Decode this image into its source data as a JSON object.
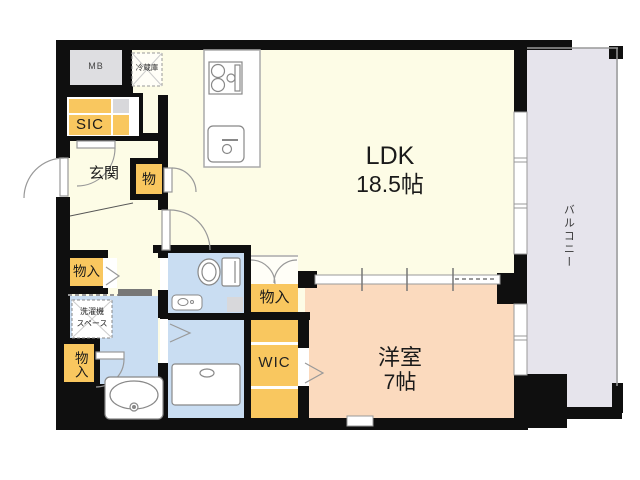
{
  "rooms": {
    "ldk": {
      "name": "LDK",
      "size": "18.5帖"
    },
    "western": {
      "name": "洋室",
      "size": "7帖"
    },
    "balcony": "バルコニー",
    "entrance": "玄関",
    "sic": "SIC",
    "wic": "WIC",
    "meter_box": "MB",
    "refrigerator": "冷蔵庫",
    "washer_space_line1": "洗濯機",
    "washer_space_line2": "スペース",
    "storage_hall": "物入",
    "storage_entry": "物",
    "storage_ldk": "物入",
    "storage_bath": "物入"
  },
  "colors": {
    "floor_ldk": "#fdfce6",
    "floor_western": "#fbdabe",
    "floor_wet": "#c9ddf2",
    "closet": "#f9c75f",
    "balcony": "#e6e4ec",
    "meter_box": "#dedee1",
    "wall": "#0f0f0f",
    "fixture_outline": "#888888"
  }
}
